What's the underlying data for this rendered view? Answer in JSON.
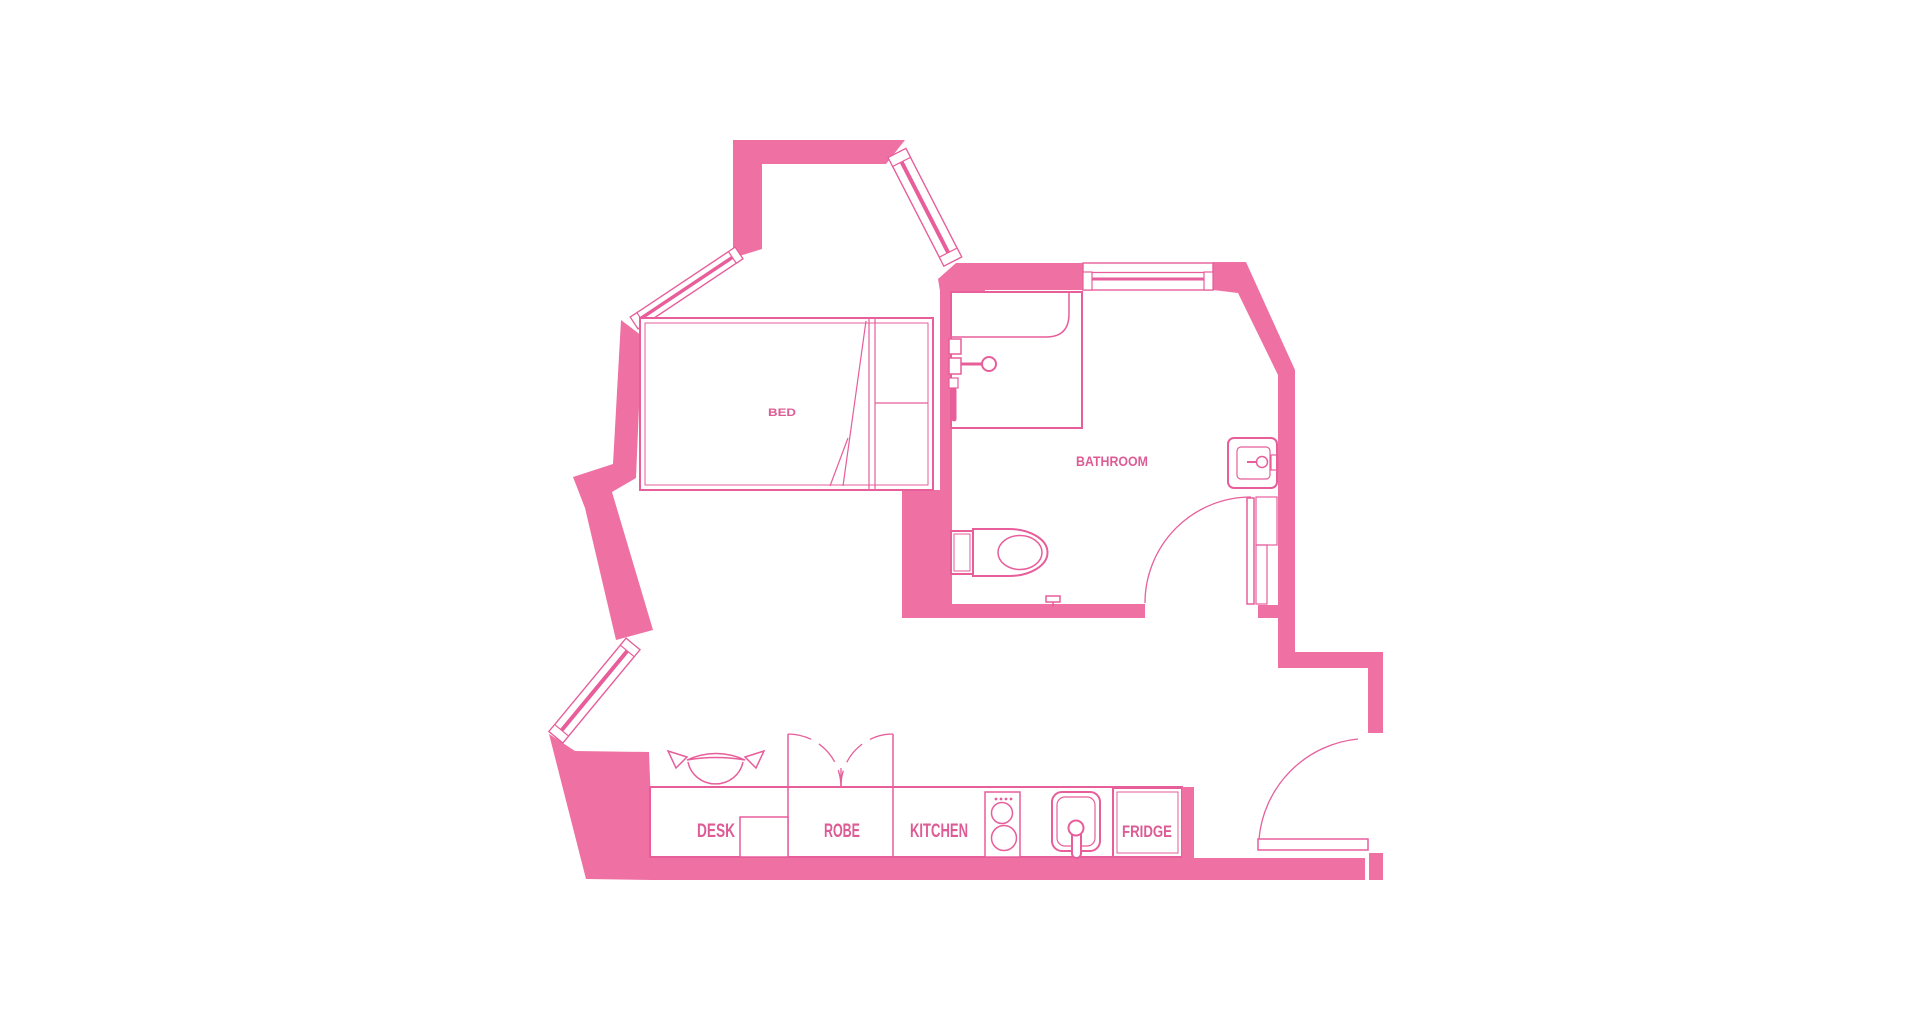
{
  "title": "Studio apartment floor plan",
  "labels": {
    "bed": "BED",
    "bathroom": "BATHROOM",
    "desk": "DESK",
    "robe": "ROBE",
    "kitchen": "KITCHEN",
    "fridge": "FRIDGE"
  },
  "colors": {
    "wall_fill": "#EF71A3",
    "line": "#E75E9B",
    "label_text": "#DD5C95",
    "background": "#FFFFFF"
  }
}
